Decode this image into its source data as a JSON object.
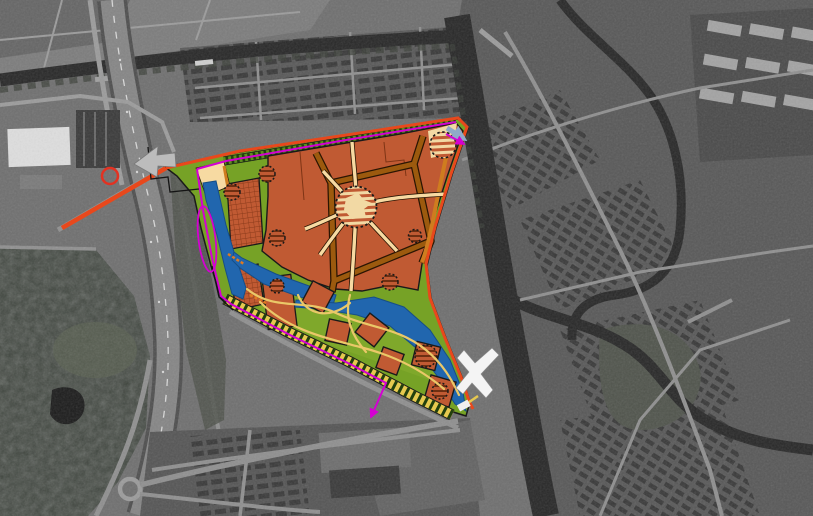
{
  "canvas": {
    "width": 813,
    "height": 516,
    "type": "map",
    "description": "Grayscale aerial photograph of a Dutch town with a colored urban masterplan overlay: terracotta residential area with ring road and circular plazas, green park with water channels, pedestrian bridge over canal, magenta route lines and red perimeter road"
  },
  "palette": {
    "photo-base": "#6f6f6f",
    "photo-field": "#7c7c7c",
    "photo-field-dark": "#656565",
    "photo-forest": "#3e443d",
    "photo-marsh": "#596052",
    "photo-pond": "#1c1c1c",
    "photo-canal": "#282828",
    "photo-treeline": "#3a3f38",
    "photo-road": "#8f8f8f",
    "photo-road-bright": "#9b9b9b",
    "photo-highway": "#858585",
    "photo-highway-edge": "#4e4e4e",
    "photo-dash": "#d8d8d8",
    "photo-urban": "#585858",
    "photo-urban-dark": "#4a4a4a",
    "photo-houses-dark": "#393939",
    "photo-block-dark": "#3a3a3a",
    "photo-building-white": "#dedede",
    "photo-apartment-light": "#a3a3a3",
    "photo-median": "#50544c",
    "photo-bottom": "#555555",
    "photo-lot": "#636363",
    "site-green": "#76a226",
    "park-green-light": "#86ad2f",
    "strip-green": "#5d8f1d",
    "tick-green-dark": "#22400e",
    "water-blue": "#2166ae",
    "water-edge": "#174e87",
    "residential": "#c05a33",
    "crosshatch-line": "#8a3a1a",
    "parcel-line": "#7e3415",
    "road-brown": "#9c5a0e",
    "road-dark-edge": "#2a1503",
    "road-orange": "#cf7c1f",
    "bridge-dash-orange": "#e07a20",
    "path-cream": "#f7daa2",
    "plaza-cream": "#f2d9a4",
    "hatch-brown": "#6e2f12",
    "path-yellow": "#eac868",
    "band-yellow": "#e6c94f",
    "line-red": "#e8481c",
    "marker-red": "#e23222",
    "line-magenta": "#d400d2",
    "arrow-blue": "#8fa9c9",
    "outline-dark": "#1a1a1a",
    "bridge-white": "#f4f4f4",
    "landing-white": "#f0f0f0",
    "arrow-gray": "#bcbcbc"
  },
  "features": {
    "aerial_photo": [
      "motorway-west",
      "north-canal",
      "east-canal",
      "winding-river-east",
      "town-center-east",
      "residential-rows-north",
      "apartment-blocks-northeast",
      "white-warehouse-northwest",
      "forest-park-southwest",
      "pond-southwest",
      "roundabout-southwest",
      "residential-blocks-south",
      "parking-lots-south"
    ],
    "masterplan_overlay": [
      "site-boundary",
      "residential-development-area",
      "gridded-development-blocks",
      "central-plaza-circle",
      "tree-plaza-circles",
      "internal-ring-road",
      "cream-pedestrian-paths",
      "south-park-zone",
      "water-channels",
      "park-pavilion-squares",
      "winding-park-paths",
      "tree-lined-south-edge",
      "tree-lined-north-edge",
      "red-perimeter-road",
      "magenta-route-lines",
      "blue-connection-arrow",
      "white-pedestrian-bridge",
      "red-circle-marker",
      "magenta-ellipse-marker",
      "gray-entry-arrow"
    ]
  }
}
